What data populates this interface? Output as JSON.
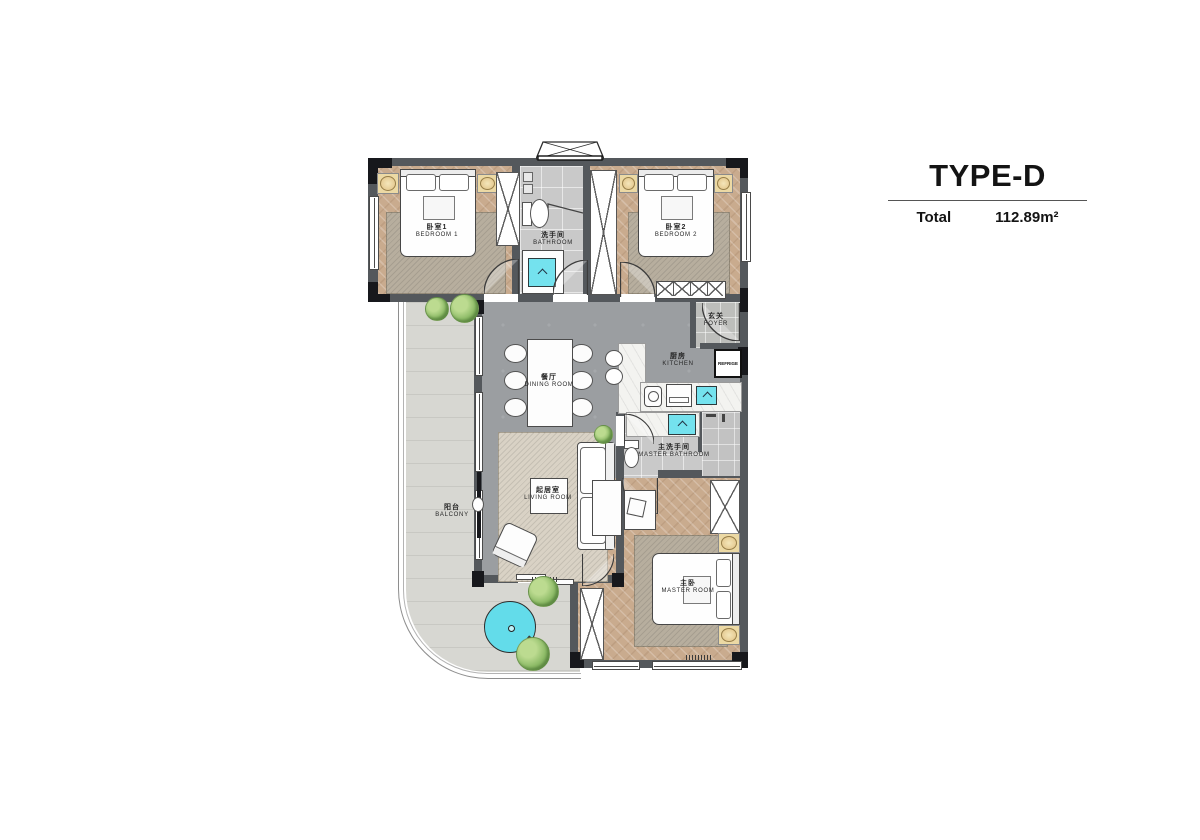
{
  "title_block": {
    "type_name": "TYPE-D",
    "total_label": "Total",
    "area_value": "112.89m²"
  },
  "rooms": {
    "bedroom1": {
      "zh": "卧室1",
      "en": "BEDROOM 1"
    },
    "bathroom": {
      "zh": "洗手间",
      "en": "BATHROOM"
    },
    "bedroom2": {
      "zh": "卧室2",
      "en": "BEDROOM 2"
    },
    "foyer": {
      "zh": "玄关",
      "en": "FOYER"
    },
    "kitchen": {
      "zh": "厨房",
      "en": "KITCHEN"
    },
    "dining_room": {
      "zh": "餐厅",
      "en": "DINING ROOM"
    },
    "living_room": {
      "zh": "起居室",
      "en": "LIVING ROOM"
    },
    "master_bathroom": {
      "zh": "主洗手间",
      "en": "MASTER BATHROOM"
    },
    "master_room": {
      "zh": "主卧",
      "en": "MASTER ROOM"
    },
    "balcony": {
      "zh": "阳台",
      "en": "BALCONY"
    }
  },
  "appliances": {
    "refrigerator_label": "REFRIGE"
  },
  "colors": {
    "wall": "#54585c",
    "column": "#17181c",
    "accent_cyan": "#74e2ee",
    "wood_floor": "#c9ab8e",
    "tile_floor": "#c9c9c9",
    "open_floor": "#9b9ea1",
    "balcony_floor": "#d7d7d2",
    "nightstand": "#ecd9a4",
    "plant_green": "#8cba66",
    "rug": "#b7ae9e",
    "living_rug": "#d9d2c5"
  }
}
